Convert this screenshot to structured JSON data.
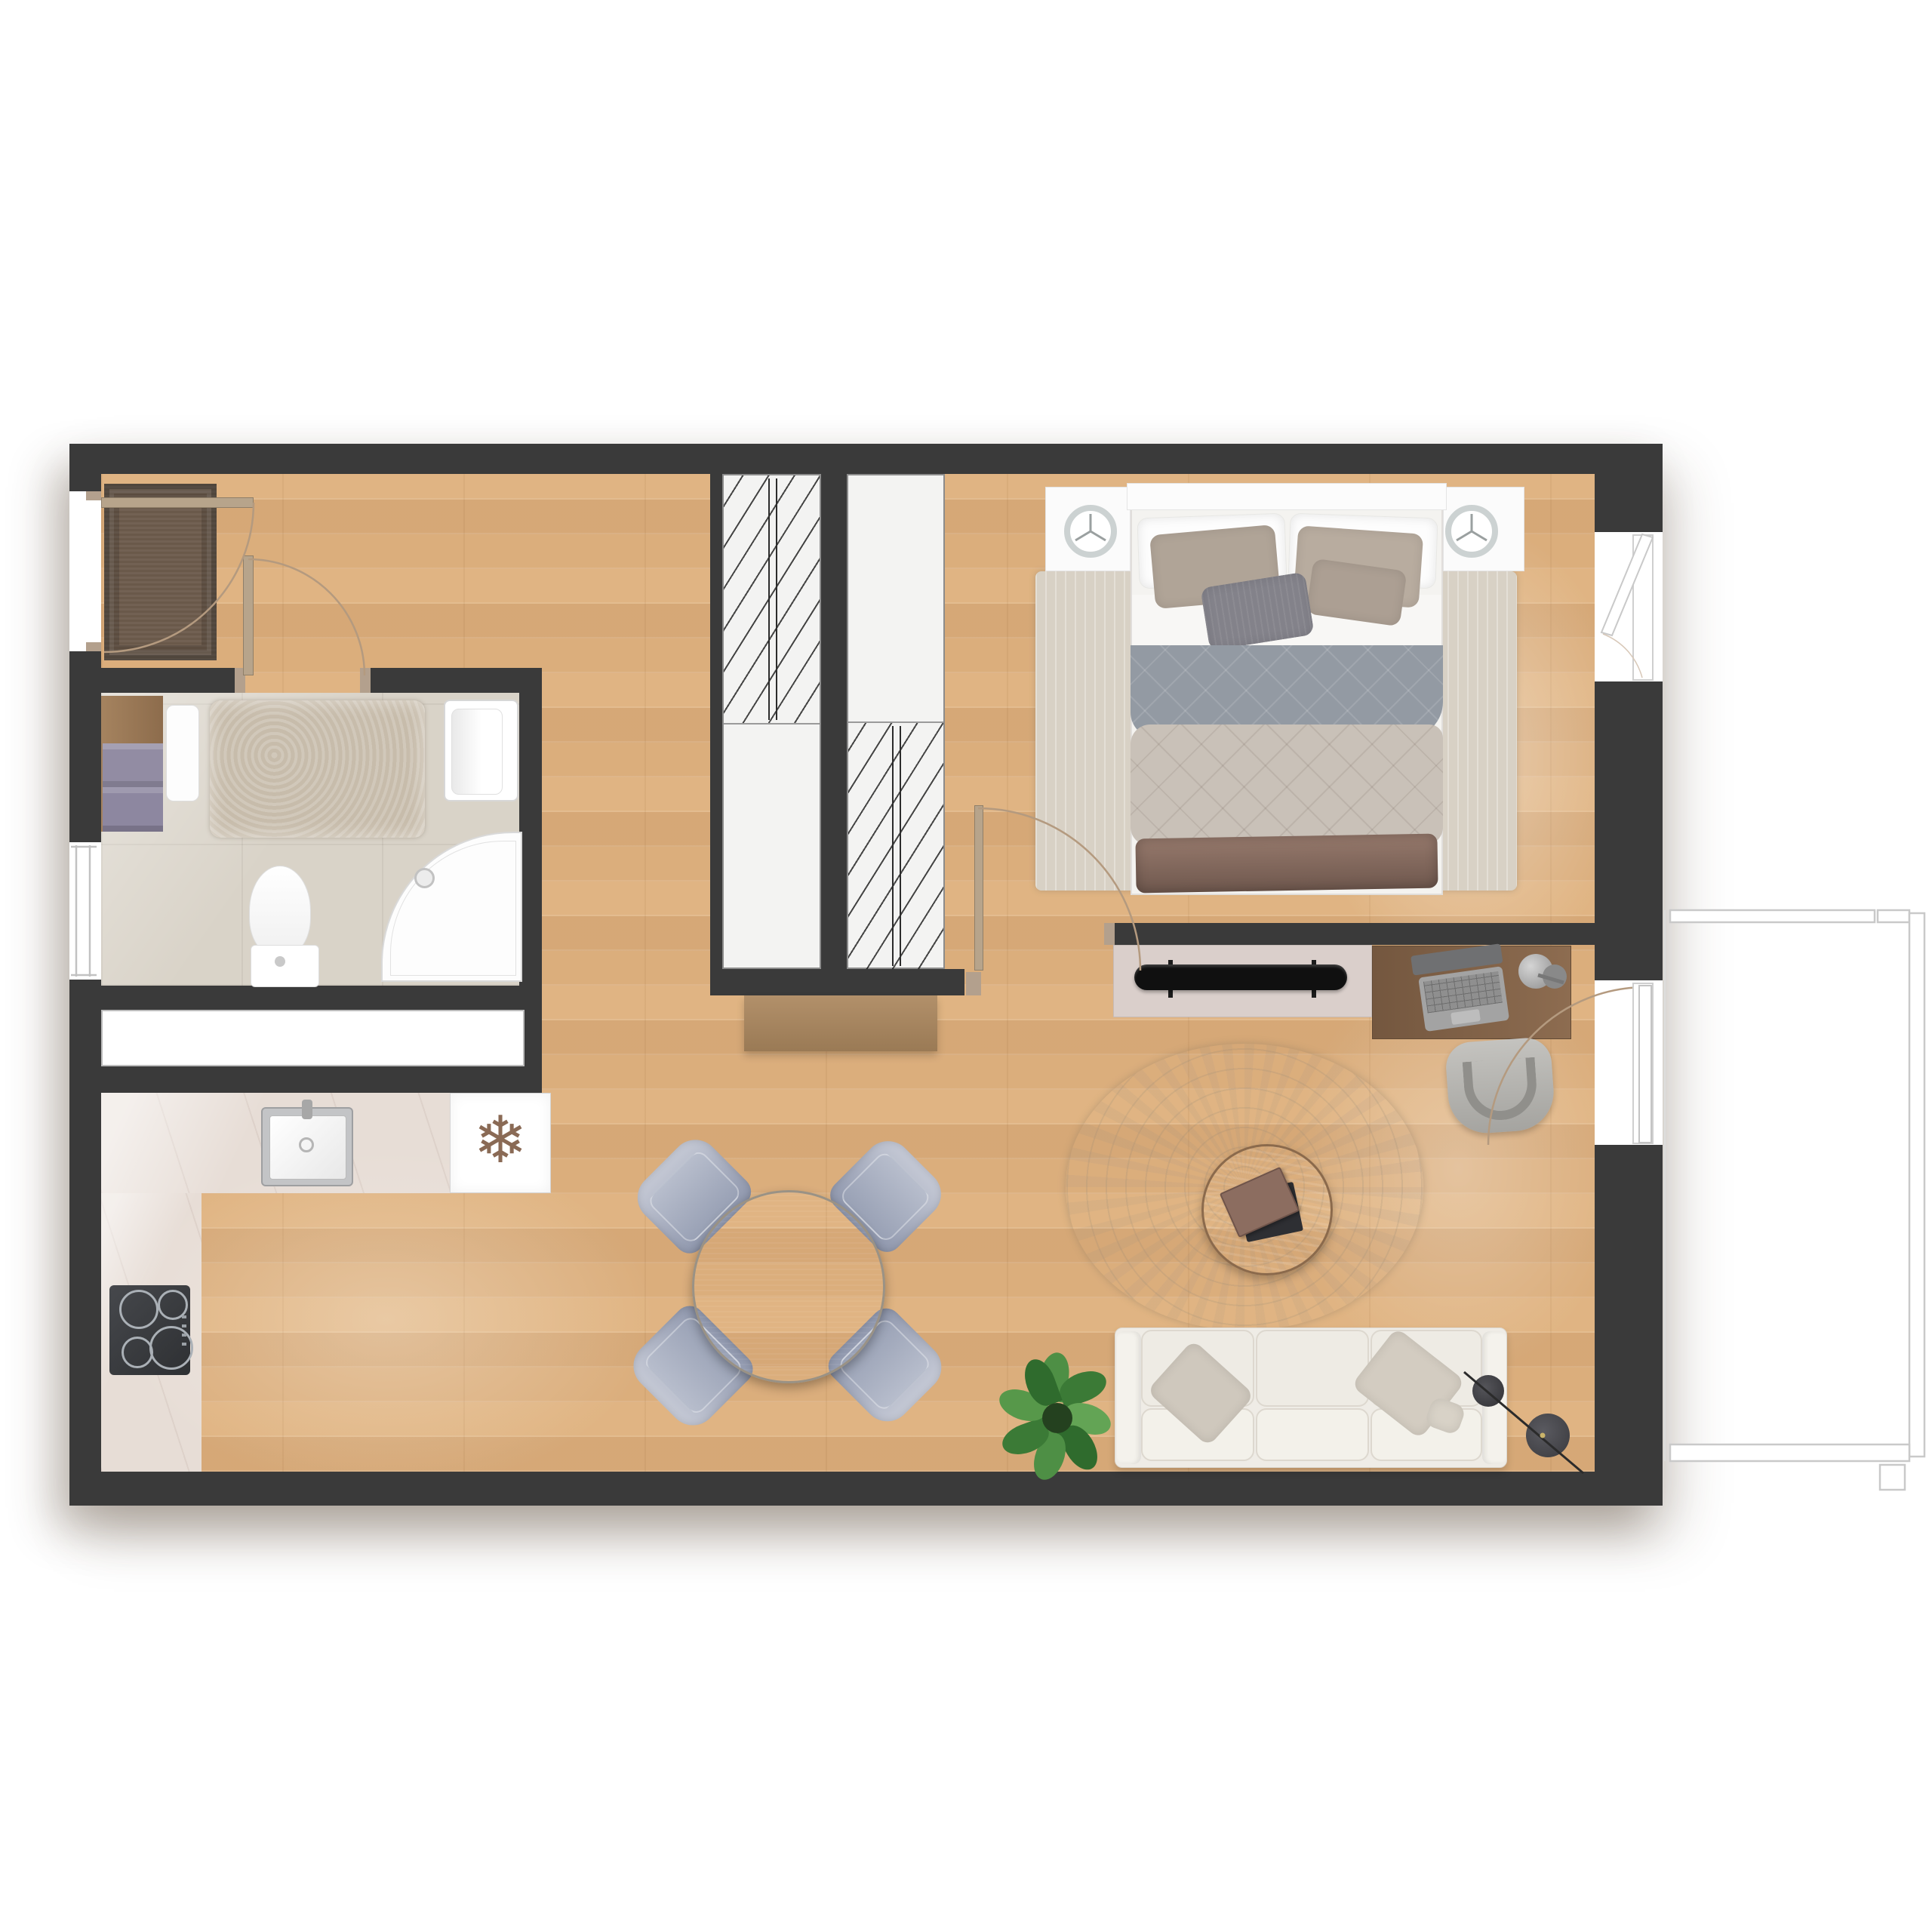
{
  "meta": {
    "type": "apartment-floor-plan",
    "view": "top-down-render",
    "rooms_count": 4
  },
  "palette": {
    "wall": "#3a3a3a",
    "wood": "#ddb181",
    "tile": "#d9d3c8",
    "marble": "#e7ddd6",
    "closet": "#f3f3f2",
    "doormat": "#6a594a",
    "doorTan": "#b7a48b",
    "jamb": "#b3a08d",
    "arc": "#b49a7f",
    "bathRug": "#c7bcab",
    "vanity": "#9b7b5e",
    "towel": "#928ca3",
    "fixtureBorder": "#d7d7d7",
    "steel": "#c3c4c6",
    "stove": "#3a3c3f",
    "burner": "#aab0b6",
    "snowflake": "#8a6a55",
    "bedRug": "#d8d1c5",
    "nightstand": "#fbfbfb",
    "bedBase": "#f4f3f0",
    "pillowWhite": "#fdfdfd",
    "pillowTaupe": "#b0a497",
    "pillowDark": "#83828a",
    "blanketGray": "#939aa3",
    "duvet": "#c9c1b8",
    "throw": "#8f7266",
    "sideboard": "#dacfcb",
    "tv": "#101010",
    "desk": "#7c5e45",
    "laptop": "#a3a3a3",
    "chairGray": "#b3b2ae",
    "rugRound": "#ece5d9",
    "tableDark": "#3c3f41",
    "chairBlue": "#9aa2b6",
    "sofa": "#efece6",
    "sofaCushion": "#f3f1ea",
    "plantGreen": "#4e8f45",
    "plantDark": "#2f6b2d",
    "lamp": "#46464a",
    "balconyLine": "#c9c9c9"
  },
  "icons": {
    "snowflake": {
      "name": "snowflake-icon",
      "glyph": "❄"
    }
  },
  "rooms": [
    {
      "id": "entry-hall",
      "label": "entry hall"
    },
    {
      "id": "bathroom",
      "label": "bathroom"
    },
    {
      "id": "kitchen",
      "label": "kitchen"
    },
    {
      "id": "living-dining",
      "label": "living and dining room"
    },
    {
      "id": "bedroom",
      "label": "bedroom"
    },
    {
      "id": "balcony",
      "label": "balcony"
    }
  ],
  "furniture": [
    {
      "room": "entry-hall",
      "items": [
        "doormat",
        "entry-door",
        "wardrobe-left",
        "wardrobe-right",
        "hall-bench"
      ]
    },
    {
      "room": "bathroom",
      "items": [
        "vanity-shelf",
        "towels",
        "cabinet",
        "bath-rug",
        "wall-sink",
        "toilet",
        "corner-shower",
        "window"
      ]
    },
    {
      "room": "kitchen",
      "items": [
        "counter",
        "kitchen-sink",
        "fridge",
        "cooktop"
      ]
    },
    {
      "room": "living-dining",
      "items": [
        "dining-table",
        "dining-chair-x4",
        "round-rug",
        "coffee-table",
        "books",
        "sofa",
        "sofa-pillows",
        "plant",
        "floor-lamp"
      ]
    },
    {
      "room": "bedroom",
      "items": [
        "double-bed",
        "pillows",
        "blanket",
        "duvet",
        "throw",
        "nightstand-left",
        "nightstand-right",
        "clock-left",
        "clock-right",
        "area-rug",
        "tv-sideboard",
        "tv",
        "desk",
        "laptop",
        "desk-lamp",
        "desk-chair",
        "window",
        "door"
      ]
    },
    {
      "room": "balcony",
      "items": [
        "railing"
      ]
    }
  ]
}
